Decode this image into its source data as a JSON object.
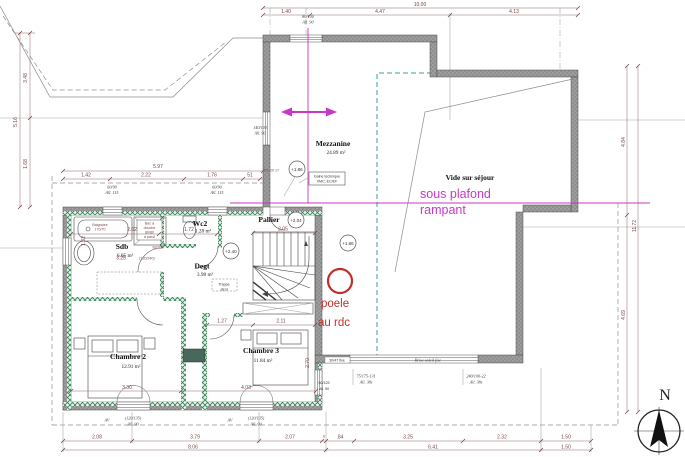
{
  "rooms": {
    "mezzanine": {
      "name": "Mezzanine",
      "area": "24.89 m²"
    },
    "vide_sejour": {
      "name": "Vide sur séjour"
    },
    "pallier": {
      "name": "Pallier"
    },
    "sdb": {
      "name": "Sdb",
      "area": "6.05 m²"
    },
    "wc2": {
      "name": "Wc2",
      "area": "1.28 m²"
    },
    "degt": {
      "name": "Degt",
      "area": "3.98 m²"
    },
    "chambre2": {
      "name": "Chambre 2",
      "area": "12.91 m²"
    },
    "chambre3": {
      "name": "Chambre 3",
      "area": "11.84 m²"
    }
  },
  "levels": {
    "mezzanine": "+1.86",
    "pallier": "+2.04",
    "stair": "+1.86",
    "degt": "+2.40"
  },
  "annotations": {
    "sous_plafond_line1": "sous plafond",
    "sous_plafond_line2": "rampant",
    "poele_line1": "poele",
    "poele_line2": "au rdc",
    "gaine_line1": "Gaine technique",
    "gaine_line2": "VMC, EC/EF",
    "trappe_line1": "Trappe",
    "trappe_line2": "atrol",
    "compass": "N"
  },
  "windows": {
    "top": {
      "l1": "80/100",
      "l2": "All. 90"
    },
    "left": {
      "l1": "140/100",
      "l2": "All. 90"
    },
    "wing1": {
      "l1": "60/90",
      "l2": "All. 115"
    },
    "wing2": {
      "l1": "60/90",
      "l2": "All. 115"
    },
    "bottom1": {
      "l1": "(120/135)",
      "l2": "All. 90"
    },
    "bottom2": {
      "l1": "(120/135)",
      "l2": "All. 90"
    },
    "stairwall": {
      "l1": "60/125",
      "l2": "All. 90"
    },
    "fixe_small": "30/47 fixe",
    "brise_soleil": "Brise-soleil fixe",
    "roof1": {
      "l1": "75/175-131",
      "l2": "All. 38s"
    },
    "roof2": {
      "l1": "240/100-22",
      "l2": "All. 38s"
    },
    "av": "AV"
  },
  "doors": {
    "porte": "83/208",
    "baie": "(120/240)"
  },
  "fixtures": {
    "baignoire_l1": "Baignoire",
    "baignoire_l2": "170/70",
    "douche_l1": "Bac à",
    "douche_l2": "douche",
    "douche_l3": "80/80",
    "douche_l4": "à paroi"
  },
  "dims": {
    "top_total": "10.00",
    "top": [
      "1.40",
      "4.47",
      "4.13"
    ],
    "left": [
      "3.48",
      "1.68",
      "5.16"
    ],
    "right": [
      "4.84",
      "4.69",
      "11.72"
    ],
    "wing_top_total": "5.97",
    "wing_top": [
      "1.42",
      "2.22",
      "1.76",
      "51",
      "20 20 17"
    ],
    "interior": [
      "2.62",
      "1.72",
      "1.82",
      "3.25",
      "2.05",
      "2.11",
      "1.27",
      "3.30",
      "4.03",
      "2.70"
    ],
    "bottom_a": [
      "2.08",
      "3.79",
      "2.07",
      "6",
      ".84",
      "3.25",
      "2.32",
      "1.50"
    ],
    "bottom_b": [
      "8.06",
      "6.41",
      "1.50"
    ]
  }
}
